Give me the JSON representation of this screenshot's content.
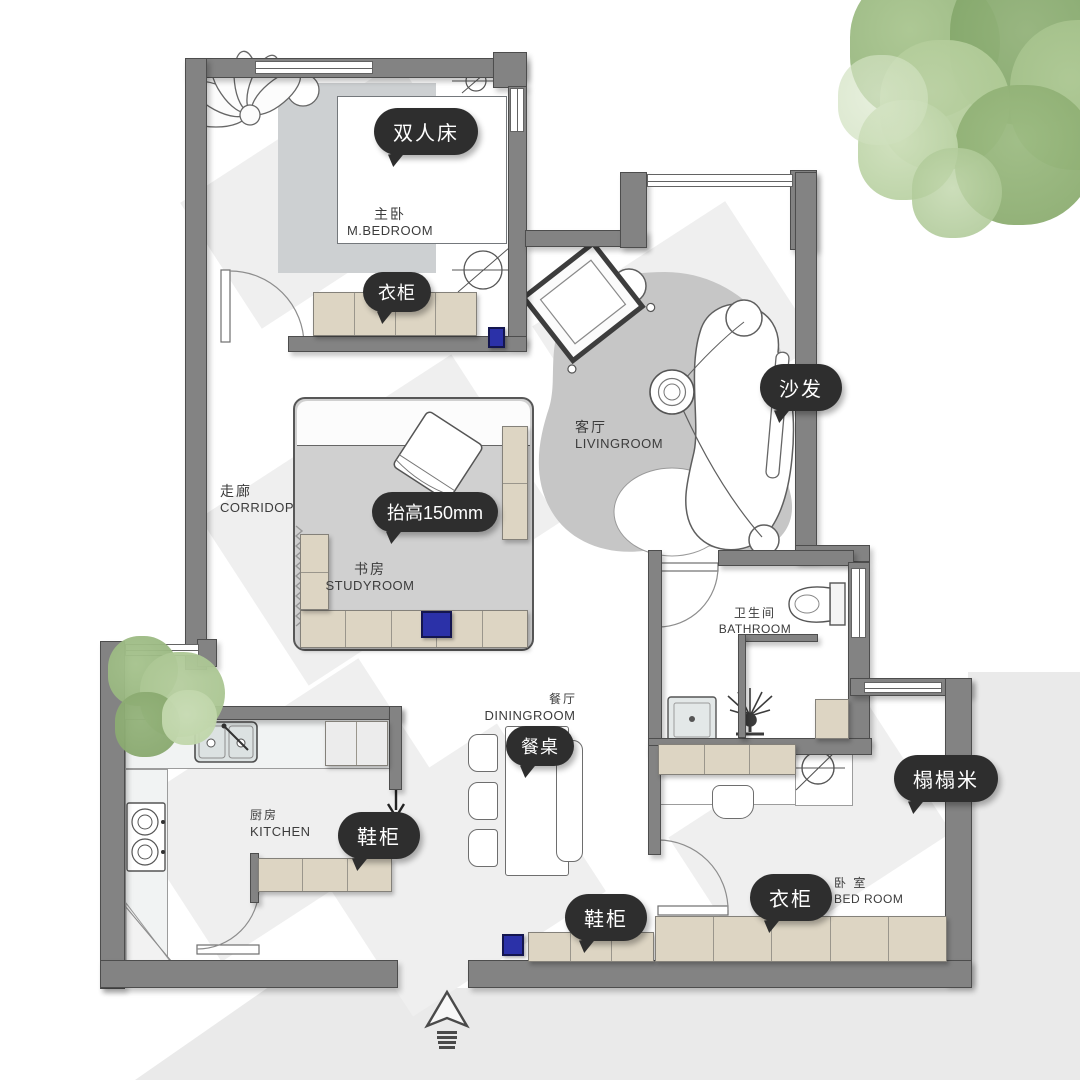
{
  "meta": {
    "title": "apartment floor plan",
    "style": "rendered plan with callouts",
    "language": "zh-CN"
  },
  "rooms": {
    "master_bedroom": {
      "cn": "主卧",
      "en": "M.BEDROOM"
    },
    "living_room": {
      "cn": "客厅",
      "en": "LIVINGROOM"
    },
    "corridor": {
      "cn": "走廊",
      "en": "CORRIDOP"
    },
    "study": {
      "cn": "书房",
      "en": "STUDYROOM"
    },
    "bathroom": {
      "cn": "卫生间",
      "en": "BATHROOM"
    },
    "dining": {
      "cn": "餐厅",
      "en": "DININGROOM"
    },
    "kitchen": {
      "cn": "厨房",
      "en": "KITCHEN"
    },
    "bedroom": {
      "cn": "卧 室",
      "en": "BED ROOM"
    }
  },
  "callouts": {
    "double_bed": "双人床",
    "wardrobe_master": "衣柜",
    "sofa": "沙发",
    "raised_floor": "抬高150mm",
    "dining_table": "餐桌",
    "shoe_cabinet_kitchen": "鞋柜",
    "shoe_cabinet_entry": "鞋柜",
    "wardrobe_bedroom": "衣柜",
    "tatami": "榻榻米"
  },
  "colors": {
    "wall": "#838383",
    "cabinet": "#ddd5c3",
    "callout_bg": "#2e2e2e",
    "callout_text": "#ffffff",
    "accent_blue": "#2b31a8",
    "rug": "#c6c6c6",
    "tree_green": "#9db884",
    "ground_shadow": "#eaeaea"
  }
}
